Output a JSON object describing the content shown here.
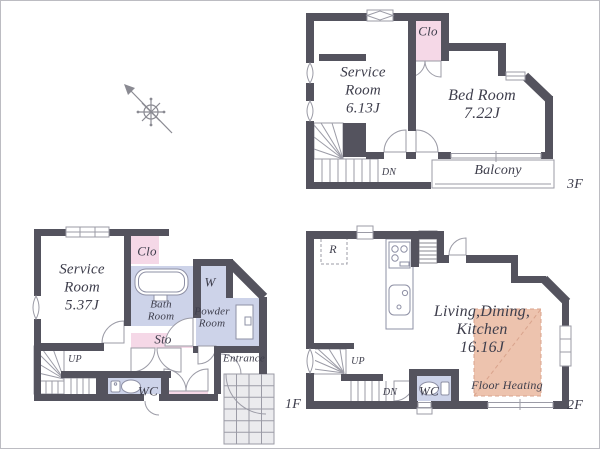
{
  "colors": {
    "wall": "#54535e",
    "pink": "#f5d8e7",
    "lav": "#cdd3e9",
    "salmon": "#edc3ae",
    "salmon_line": "#d9a38c",
    "line": "#9b9ba6",
    "text": "#3e3e4c",
    "tile": "#ebebee"
  },
  "floor_3f": {
    "floor_label": "3F",
    "service_room": [
      "Service",
      "Room",
      "6.13J"
    ],
    "bed_room": [
      "Bed Room",
      "7.22J"
    ],
    "closet": "Clo",
    "balcony": "Balcony",
    "stairs_down": "DN"
  },
  "floor_1f": {
    "floor_label": "1F",
    "service_room": [
      "Service",
      "Room",
      "5.37J"
    ],
    "closet": "Clo",
    "bath_room": [
      "Bath",
      "Room"
    ],
    "washer": "W",
    "powder_room": [
      "Powder",
      "Room"
    ],
    "storage": "Sto",
    "toilet": "WC",
    "entrance": "Entrance",
    "stairs_up": "UP"
  },
  "floor_2f": {
    "floor_label": "2F",
    "ldk": [
      "Living,Dining,",
      "Kitchen",
      "16.16J"
    ],
    "refrigerator": "R",
    "toilet": "WC",
    "floor_heating": "Floor Heating",
    "stairs_up": "UP",
    "stairs_down": "DN"
  }
}
